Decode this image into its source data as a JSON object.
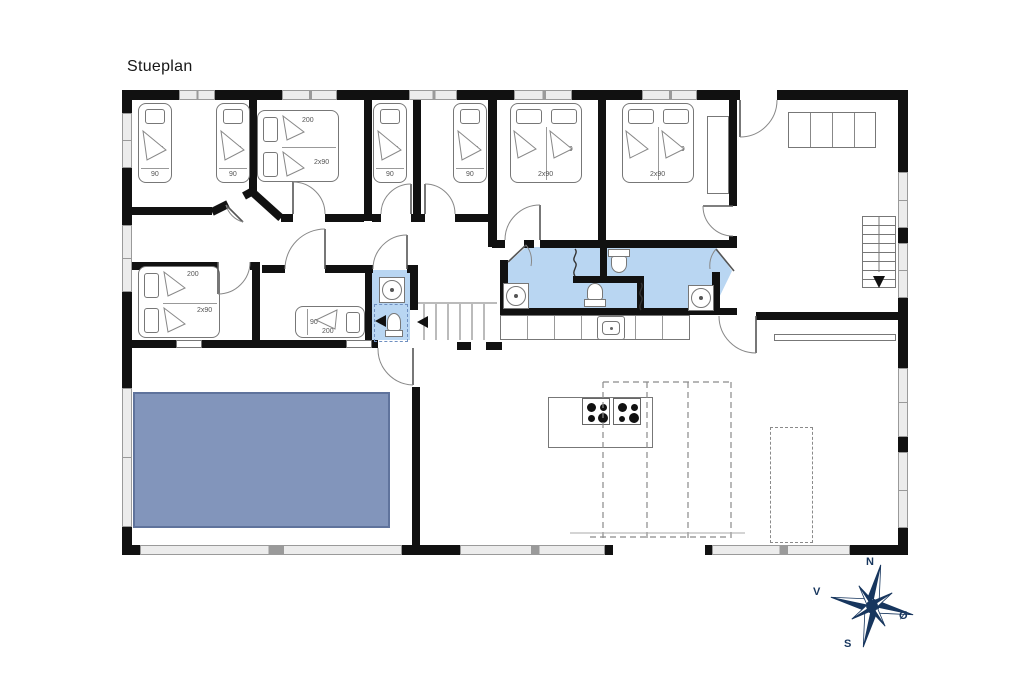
{
  "title": "Stueplan",
  "compass": {
    "north": "N",
    "south": "S",
    "west": "V",
    "east": "Ø"
  },
  "beds": {
    "bedroom1_bed1": {
      "length": "200",
      "width": "90"
    },
    "bedroom1_bed2": {
      "length": "200",
      "width": "90"
    },
    "bedroom2_double": {
      "length": "200",
      "width": "2x90"
    },
    "bedroom3_bed": {
      "length": "200",
      "width": "90"
    },
    "bedroom4_bed": {
      "length": "200",
      "width": "90"
    },
    "bedroom5_double": {
      "length": "200",
      "width": "2x90"
    },
    "bedroom6_double": {
      "length": "200",
      "width": "2x90"
    },
    "bedroom7_double": {
      "length": "200",
      "width": "2x90"
    },
    "bedroom8_bed": {
      "length": "200",
      "width": "90"
    }
  },
  "colors": {
    "wall": "#111111",
    "bathroom_floor": "#b9d6f2",
    "pool": "#8295bb",
    "window_band": "#ececec",
    "compass": "#17365e"
  }
}
